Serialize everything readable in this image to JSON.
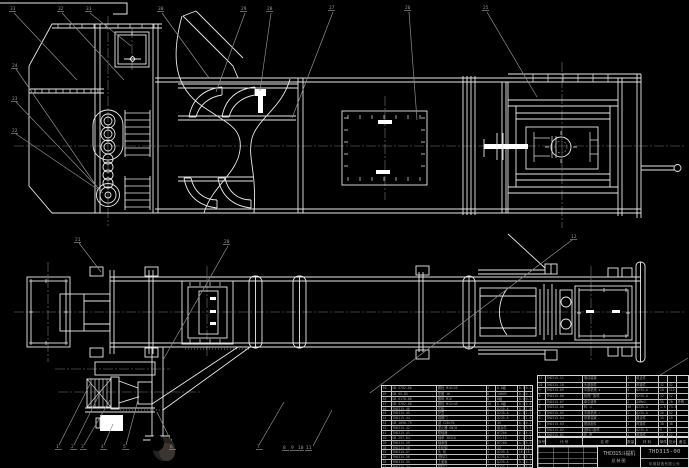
{
  "meta": {
    "type": "cad-assembly-drawing",
    "background_color": "#000000",
    "line_color": "#ececec",
    "annotation_color": "#8f8f8f"
  },
  "title_block": {
    "drawing_title_line1": "THD315斗提机",
    "drawing_title_line2": "总装图",
    "drawing_number": "THD315-00",
    "company_line": "机械制造有限公司"
  },
  "bom_right": {
    "headers": [
      "序号",
      "代 号",
      "名 称",
      "数量",
      "材 料",
      "单件",
      "总计",
      "备注"
    ],
    "rows": [
      [
        "11",
        "THD315-11",
        "驱动装置",
        "1",
        "组合件",
        "",
        "",
        ""
      ],
      [
        "10",
        "THD315-10",
        "头部部件",
        "1",
        "焊接件",
        "42",
        "42",
        ""
      ],
      [
        "9",
        "THD315-09",
        "中部机壳 Ⅱ",
        "4",
        "Q235-A",
        "28",
        "112",
        ""
      ],
      [
        "8",
        "THD315-08",
        "检视门部件",
        "1",
        "Q235-A",
        "12",
        "12",
        ""
      ],
      [
        "7",
        "THD315-07",
        "牵引链条",
        "2",
        "20Mn2",
        "35",
        "70",
        "外购"
      ],
      [
        "6",
        "THD315-06",
        "料 斗",
        "46",
        "Q235-A",
        "1.6",
        "73.6",
        ""
      ],
      [
        "5",
        "THD315-05",
        "中部机壳 Ⅰ",
        "2",
        "Q235-A",
        "26",
        "52",
        ""
      ],
      [
        "4",
        "THD315-04",
        "张紧装置",
        "1",
        "组合件",
        "15",
        "15",
        ""
      ],
      [
        "3",
        "THD315-03",
        "尾部部件",
        "1",
        "焊接件",
        "38",
        "38",
        ""
      ],
      [
        "2",
        "THD315-02",
        "进料口部件",
        "1",
        "Q235-A",
        "9",
        "9",
        ""
      ],
      [
        "1",
        "THD315-01",
        "机 座",
        "1",
        "焊接件",
        "22",
        "22",
        ""
      ]
    ]
  },
  "bom_left": {
    "rows": [
      [
        "50",
        "GB 5782-86",
        "螺栓 M16×55",
        "4",
        "8.8级",
        "0.1",
        "0.4"
      ],
      [
        "49",
        "GB 95-85",
        "垫圈 16",
        "8",
        "100HV",
        "0.01",
        "0.1"
      ],
      [
        "48",
        "GB 6170-86",
        "螺母 M16",
        "8",
        "8级",
        "0.03",
        "0.2"
      ],
      [
        "47",
        "GB 5782-86",
        "螺栓 M12×45",
        "16",
        "8.8级",
        "0.05",
        "0.8"
      ],
      [
        "46",
        "THD315-46",
        "压板",
        "2",
        "Q235-A",
        "0.5",
        "1.0"
      ],
      [
        "45",
        "THD315-45",
        "护罩",
        "1",
        "Q235-A",
        "2.5",
        "2.5"
      ],
      [
        "44",
        "THD315-44",
        "观察门",
        "1",
        "Q235-A",
        "1.8",
        "1.8"
      ],
      [
        "43",
        "GB 1096-79",
        "键 C20×70",
        "1",
        "45",
        "0.2",
        "0.2"
      ],
      [
        "42",
        "THD315-42",
        "逆止器 GN70",
        "1",
        "组合件",
        "3.5",
        "3.5"
      ],
      [
        "41",
        "THD315-41",
        "联轴器",
        "1",
        "HT200",
        "6.0",
        "6.0"
      ],
      [
        "40",
        "GB 297-84",
        "轴承 30310",
        "2",
        "GCr15",
        "1.2",
        "2.4"
      ],
      [
        "39",
        "THD315-39",
        "轴承座",
        "2",
        "HT200",
        "4.5",
        "9.0"
      ],
      [
        "38",
        "THD315-38",
        "头轮轴",
        "1",
        "45",
        "12.6",
        "12.6"
      ],
      [
        "37",
        "THD315-37",
        "头 轮",
        "1",
        "Q235-A",
        "18.2",
        "18.2"
      ],
      [
        "36",
        "THD315-36",
        "进料口",
        "1",
        "Q235-A",
        "5.4",
        "5.4"
      ],
      [
        "35",
        "THD315-35",
        "上盖板",
        "1",
        "Q235-A",
        "3.2",
        "3.2"
      ],
      [
        "34",
        "THD315-34",
        "卸料口",
        "1",
        "Q235-A",
        "4.6",
        "4.6"
      ]
    ]
  },
  "callouts": [
    {
      "label": "33",
      "x": 10,
      "y": 10
    },
    {
      "label": "32",
      "x": 58,
      "y": 10
    },
    {
      "label": "31",
      "x": 86,
      "y": 10
    },
    {
      "label": "30",
      "x": 158,
      "y": 10
    },
    {
      "label": "29",
      "x": 241,
      "y": 10
    },
    {
      "label": "28",
      "x": 267,
      "y": 10
    },
    {
      "label": "27",
      "x": 329,
      "y": 9
    },
    {
      "label": "26",
      "x": 405,
      "y": 9
    },
    {
      "label": "25",
      "x": 483,
      "y": 9
    },
    {
      "label": "24",
      "x": 12,
      "y": 67
    },
    {
      "label": "23",
      "x": 12,
      "y": 100
    },
    {
      "label": "22",
      "x": 12,
      "y": 132
    },
    {
      "label": "21",
      "x": 75,
      "y": 241
    },
    {
      "label": "20",
      "x": 224,
      "y": 243
    },
    {
      "label": "1",
      "x": 56,
      "y": 448
    },
    {
      "label": "2",
      "x": 71,
      "y": 448
    },
    {
      "label": "3",
      "x": 81,
      "y": 448
    },
    {
      "label": "4",
      "x": 101,
      "y": 448
    },
    {
      "label": "5",
      "x": 123,
      "y": 448
    },
    {
      "label": "6",
      "x": 170,
      "y": 448
    },
    {
      "label": "7",
      "x": 257,
      "y": 448
    },
    {
      "label": "8",
      "x": 283,
      "y": 449
    },
    {
      "label": "9",
      "x": 291,
      "y": 449
    },
    {
      "label": "10",
      "x": 298,
      "y": 449
    },
    {
      "label": "11",
      "x": 306,
      "y": 449
    },
    {
      "label": "12",
      "x": 571,
      "y": 238
    }
  ]
}
